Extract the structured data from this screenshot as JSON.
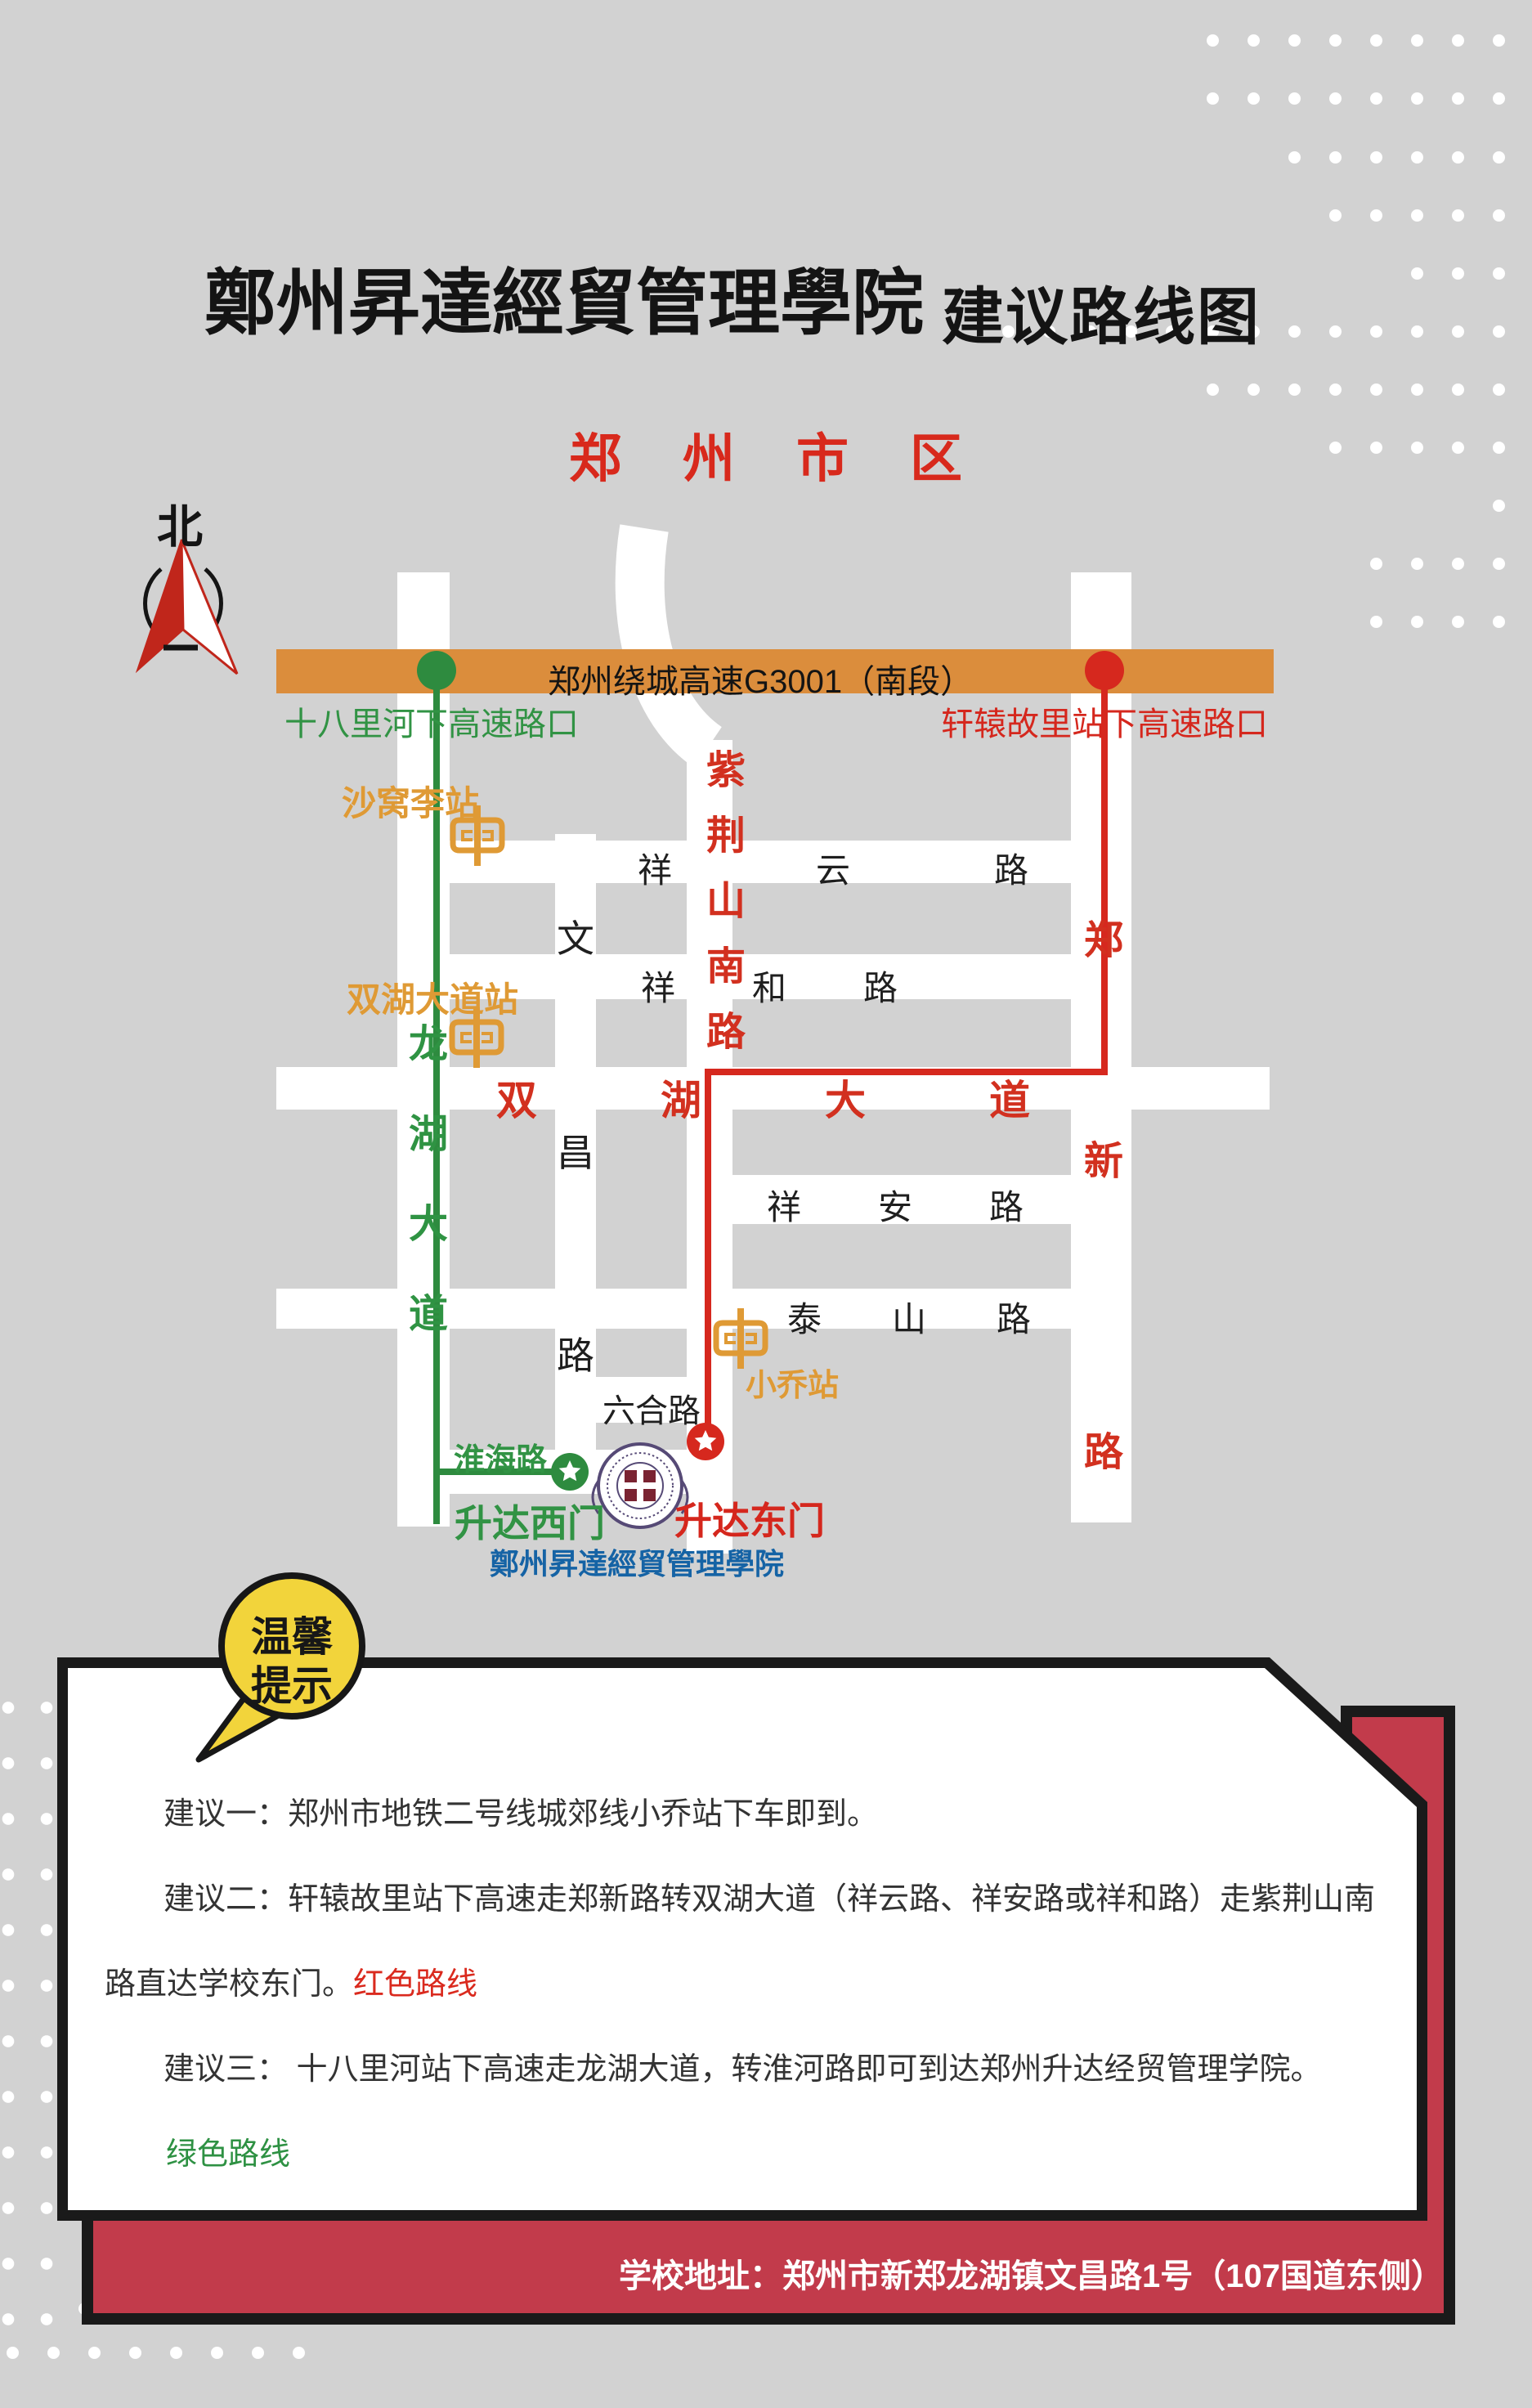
{
  "title": {
    "calligraphy": "鄭州昇達經貿管理學院",
    "suffix": "建议路线图"
  },
  "map": {
    "region_title": "郑州市区",
    "compass_north": "北",
    "highway": {
      "label": "郑州绕城高速G3001（南段）"
    },
    "exits": {
      "green": "十八里河下高速路口",
      "red": "轩辕故里站下高速路口"
    },
    "stations": {
      "shawoli": "沙窝李站",
      "shuanghu_station": "双湖大道站",
      "xiaoqiao": "小乔站"
    },
    "roads": {
      "longhu": "龙湖大道",
      "wenchang": [
        "文",
        "昌",
        "路"
      ],
      "zijinshan": "紫荆山南路",
      "zhengxin": [
        "郑",
        "新",
        "路"
      ],
      "xiangyun": "祥云路",
      "xianghe": "祥和路",
      "shuanghu": "双湖大道",
      "xiangan": "祥安路",
      "taishan": "泰山路",
      "liuhe": "六合路",
      "huaihai": "淮海路"
    },
    "gates": {
      "west": "升达西门",
      "east": "升达东门"
    },
    "school_name": "鄭州昇達經貿管理學院"
  },
  "tip": {
    "line1": "温馨",
    "line2": "提示"
  },
  "suggestions": {
    "line1": "建议一：郑州市地铁二号线城郊线小乔站下车即到。",
    "line2": "建议二：轩辕故里站下高速走郑新路转双湖大道（祥云路、祥安路或祥和路）走紫荆山南",
    "line3": "路直达学校东门。",
    "line3_highlight": "红色路线",
    "line4": "建议三： 十八里河站下高速走龙湖大道，转淮河路即可到达郑州升达经贸管理学院。",
    "line5": "绿色路线"
  },
  "footer": {
    "address": "学校地址：郑州市新郑龙湖镇文昌路1号（107国道东侧）"
  },
  "colors": {
    "background": "#D2D2D2",
    "road_white": "#FFFFFF",
    "highway_orange": "#DB8D3C",
    "route_green": "#2E8B3F",
    "route_red": "#D6281E",
    "metro_orange": "#DF9A35",
    "crimson_panel": "#C23B4B",
    "bubble_yellow": "#F2D43B",
    "school_blue": "#1563A5",
    "title_black": "#141414"
  }
}
